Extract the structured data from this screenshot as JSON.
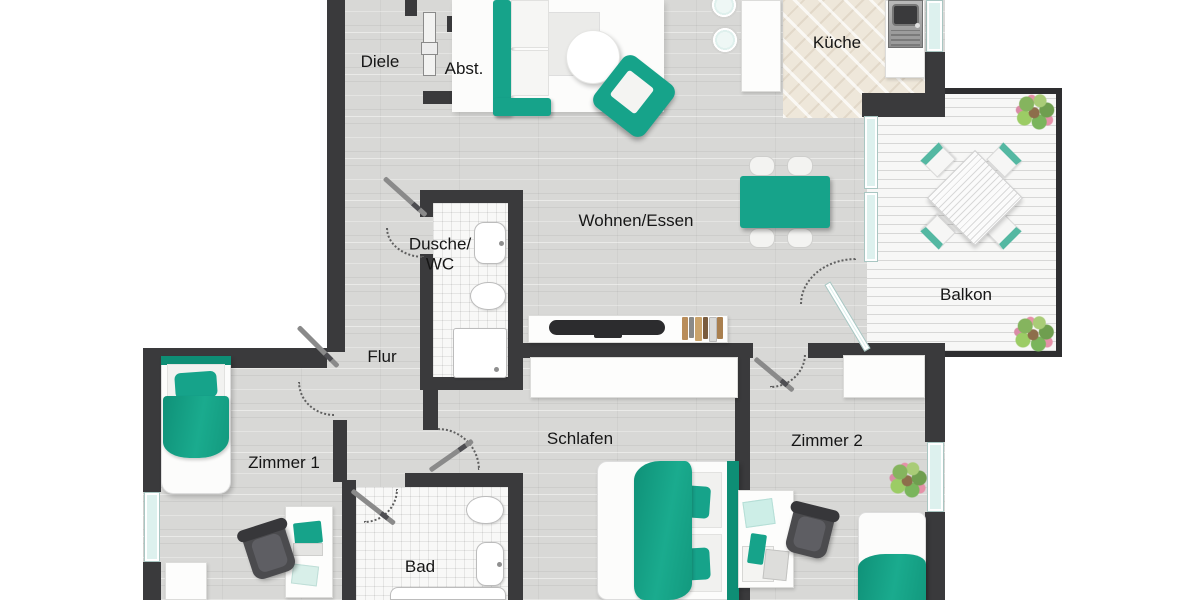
{
  "type": "apartment-floor-plan",
  "labels": {
    "diele": "Diele",
    "abst": "Abst.",
    "kueche": "Küche",
    "wohnen_essen": "Wohnen/Essen",
    "dusche_wc": "Dusche/\nWC",
    "flur": "Flur",
    "balkon": "Balkon",
    "zimmer1": "Zimmer 1",
    "schlafen": "Schlafen",
    "zimmer2": "Zimmer 2",
    "bad": "Bad"
  },
  "colors": {
    "wall": "#3a3a3c",
    "furniture_teal": "#16a38a",
    "furniture_teal_dark": "#0e8e75",
    "window_glass": "#ddf1ee",
    "floor_plank": "#d8d8d6",
    "kitchen_tile": "#eee7da",
    "bath_tile": "#f8f8f7",
    "balcony_deck": "#f7f7f6",
    "label_text": "#161616"
  },
  "rooms": {
    "diele": {
      "furniture": [
        "closet-door"
      ]
    },
    "abst": {
      "furniture": []
    },
    "wohnen_essen": {
      "furniture": [
        "corner-sofa",
        "coffee-table",
        "armchair",
        "dining-table",
        "dining-chairs-x4",
        "tv-sideboard",
        "books"
      ]
    },
    "kueche": {
      "furniture": [
        "kitchen-island",
        "plates-x2",
        "sink-unit",
        "counter"
      ]
    },
    "balkon": {
      "furniture": [
        "garden-table",
        "garden-chairs-x4",
        "plants-x2"
      ]
    },
    "dusche_wc": {
      "furniture": [
        "washbasin",
        "toilet",
        "shower"
      ]
    },
    "flur": {
      "furniture": []
    },
    "zimmer1": {
      "furniture": [
        "single-bed",
        "nightstand",
        "desk",
        "office-chair",
        "laptop"
      ]
    },
    "schlafen": {
      "furniture": [
        "wardrobe",
        "double-bed"
      ]
    },
    "zimmer2": {
      "furniture": [
        "cabinet",
        "desk",
        "office-chair",
        "single-bed",
        "plant"
      ]
    },
    "bad": {
      "furniture": [
        "toilet",
        "washbasin",
        "bathtub"
      ]
    }
  }
}
